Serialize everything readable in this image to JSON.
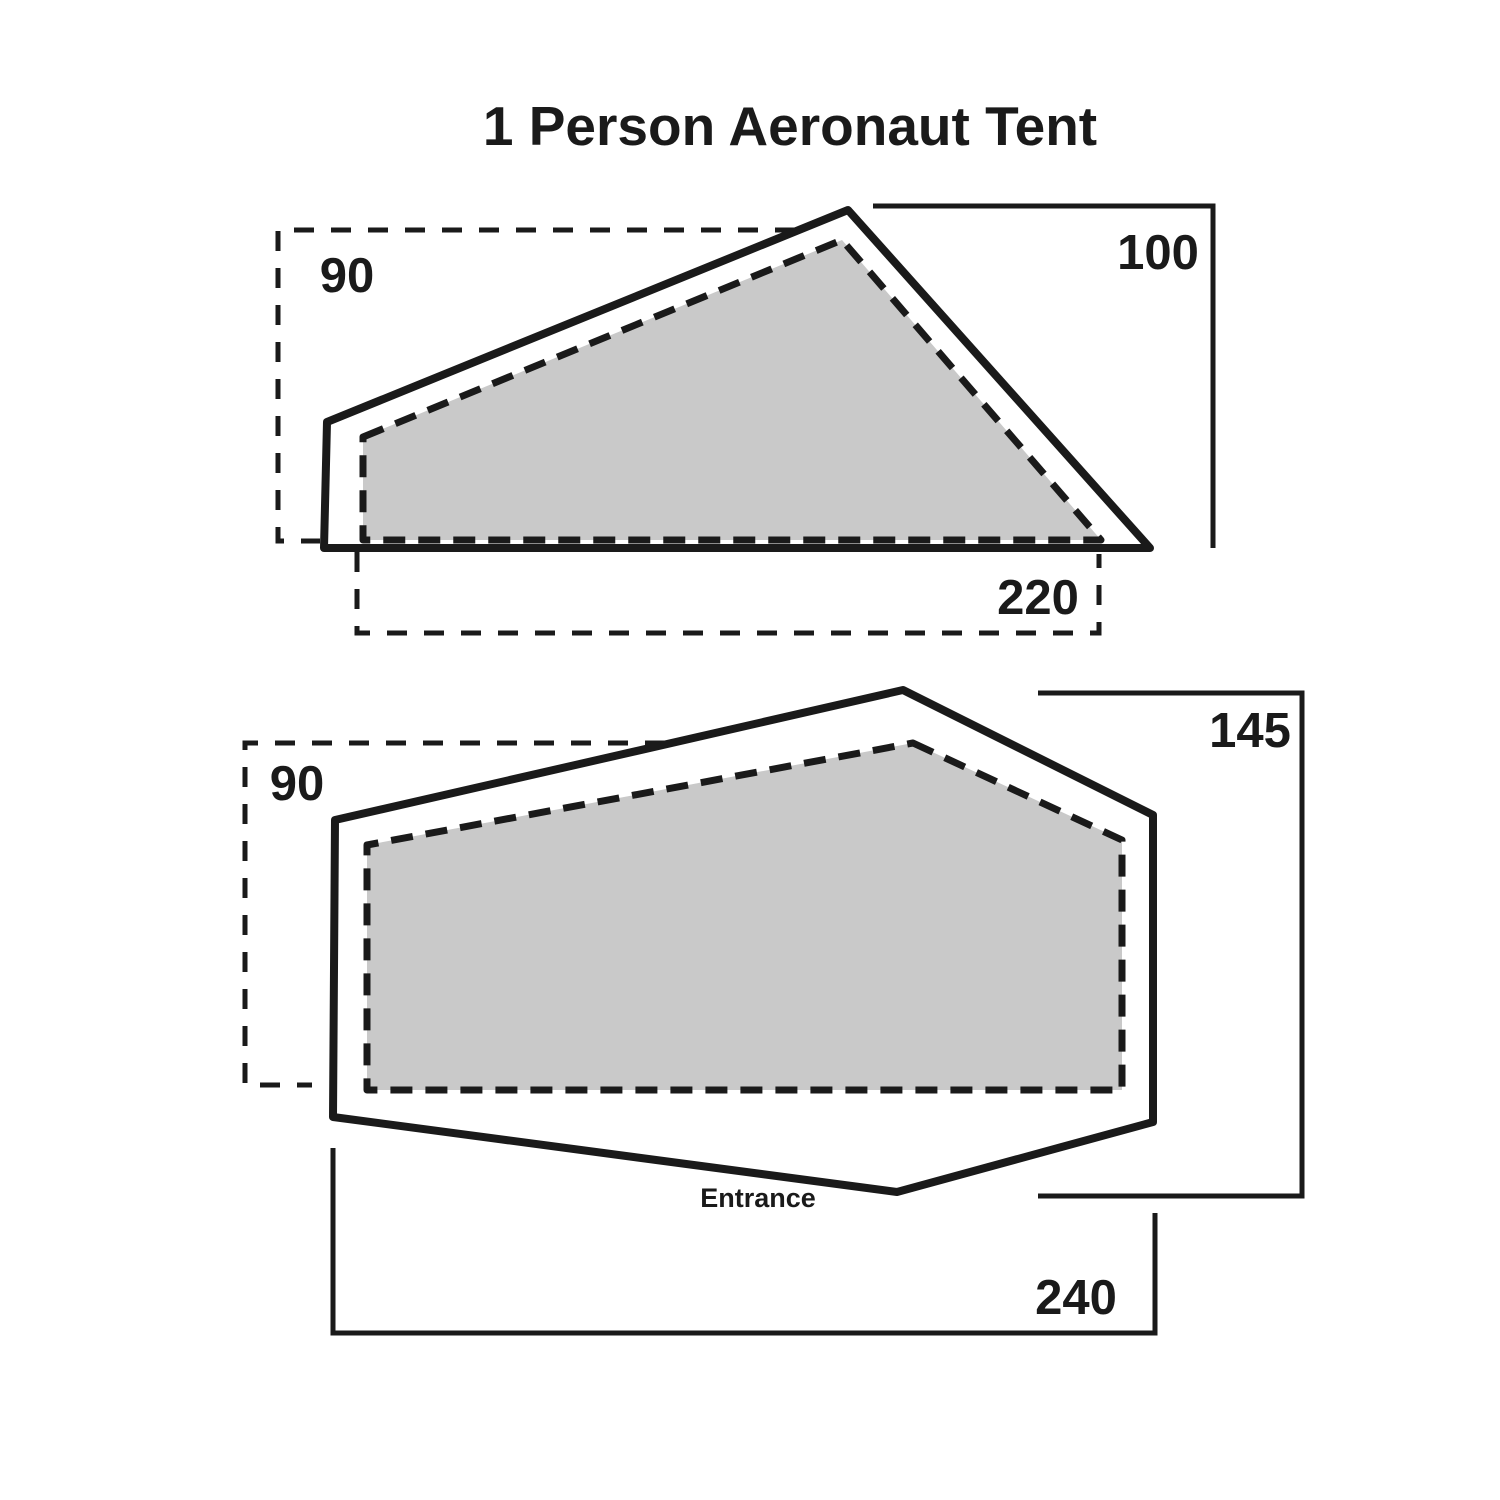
{
  "title": "1 Person Aeronaut Tent",
  "colors": {
    "line": "#1a1a1a",
    "inner_fill": "#c9c9c9",
    "background": "#ffffff"
  },
  "side_view": {
    "inner_width": "90",
    "height": "100",
    "inner_length": "220"
  },
  "floor_view": {
    "inner_width": "90",
    "width": "145",
    "length": "240",
    "entrance": "Entrance"
  }
}
